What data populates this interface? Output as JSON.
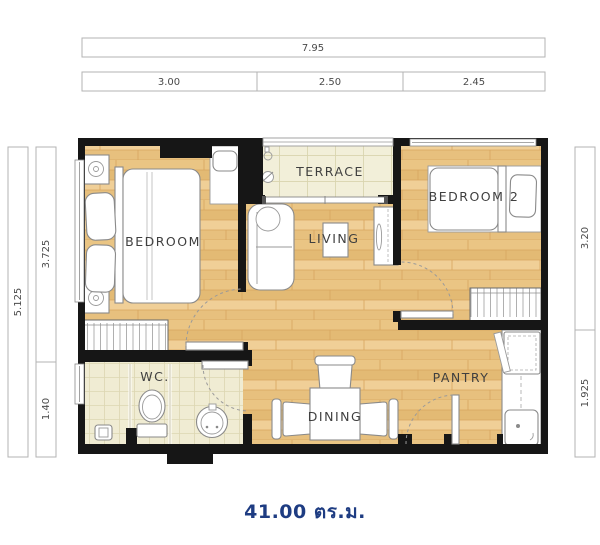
{
  "area_label": "41.00 ตร.ม.",
  "rooms": {
    "bedroom": "BEDROOM",
    "terrace": "TERRACE",
    "living": "LIVING",
    "bedroom2": "BEDROOM 2",
    "wc": "WC.",
    "dining": "DINING",
    "pantry": "PANTRY"
  },
  "dims": {
    "top_total": "7.95",
    "top_seg1": "3.00",
    "top_seg2": "2.50",
    "top_seg3": "2.45",
    "left_total": "5.125",
    "left_seg1": "3.725",
    "left_seg2": "1.40",
    "right_seg1": "3.20",
    "right_seg2": "1.925"
  },
  "colors": {
    "wall": "#161616",
    "wood_floor": "#e8c183",
    "tile_floor": "#f2efd8",
    "area_text": "#1e3c82",
    "dim_text": "#4a4a4a",
    "label_text": "#3f3f3f"
  }
}
